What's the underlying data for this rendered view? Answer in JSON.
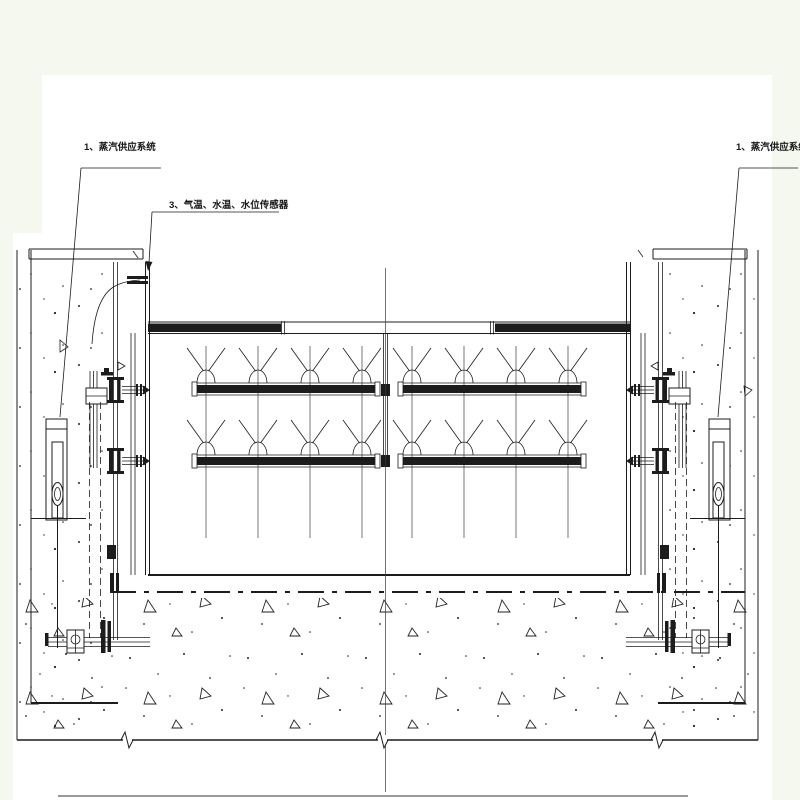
{
  "drawing": {
    "labels": {
      "steam_supply_left": "1、蒸汽供应系统",
      "sensors": "3、气温、水温、水位传感器",
      "steam_supply_right": "1、蒸汽供应系统"
    },
    "colors": {
      "background": "#f4f8ef",
      "paper": "#ffffff",
      "line": "#1c1c1c"
    }
  }
}
